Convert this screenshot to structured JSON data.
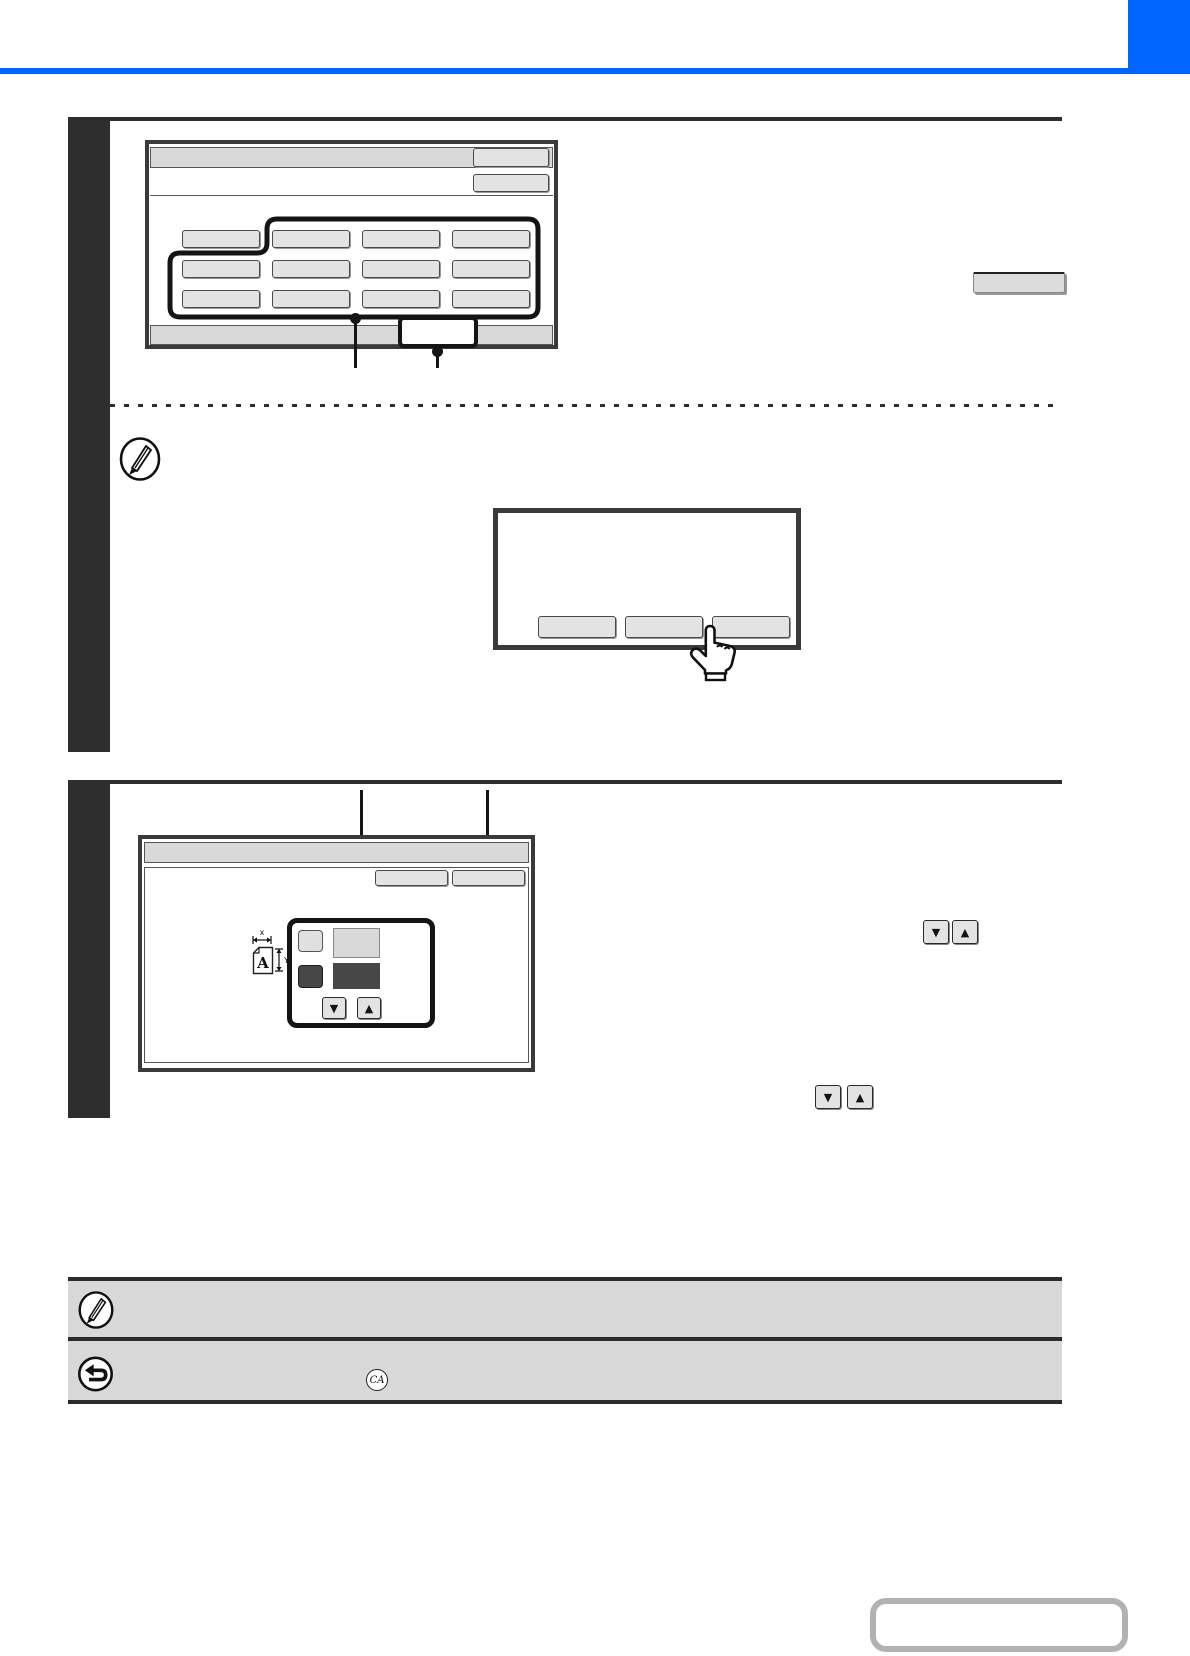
{
  "page": {
    "kind": "copier-manual-page-graphics-only",
    "colors": {
      "accent_blue": "#0066ff",
      "step_bar": "#2e2e2e",
      "panel_border": "#3a3a3a",
      "bar_fill": "#d9d9d9",
      "key_fill": "#e3e3e3",
      "highlight_outline": "#141414",
      "note_fill": "#d8d8d8",
      "nav_box_border": "#b2b2b2"
    }
  },
  "step1_screen": {
    "titlebar_keys": [
      {
        "label": ""
      }
    ],
    "subbar_keys": [
      {
        "label": ""
      }
    ],
    "size_grid": {
      "rows": 3,
      "cols": 4,
      "keys": [
        "",
        "",
        "",
        "",
        "",
        "",
        "",
        "",
        "",
        "",
        "",
        ""
      ]
    },
    "footer_key": {
      "label": ""
    }
  },
  "note_dialog": {
    "icon": "pencil-icon",
    "keys": [
      "",
      "",
      ""
    ],
    "pointer_icon": "hand-tap-icon"
  },
  "step2_screen": {
    "header_keys": [
      {
        "label": ""
      },
      {
        "label": ""
      }
    ],
    "size_panel": {
      "doc_letter": "A",
      "dim_x_label": "x",
      "dim_y_label": "Y",
      "arrow_keys": [
        "down",
        "up"
      ]
    }
  },
  "inline_refs": {
    "key_label": "",
    "arrow_pair_1": [
      "down",
      "up"
    ],
    "arrow_pair_2": [
      "down",
      "up"
    ]
  },
  "footnotes": [
    {
      "icon": "pencil-icon"
    },
    {
      "icon": "return-arrow-icon",
      "badge": "CA"
    }
  ],
  "glyphs": {
    "down": "▼",
    "up": "▲"
  }
}
